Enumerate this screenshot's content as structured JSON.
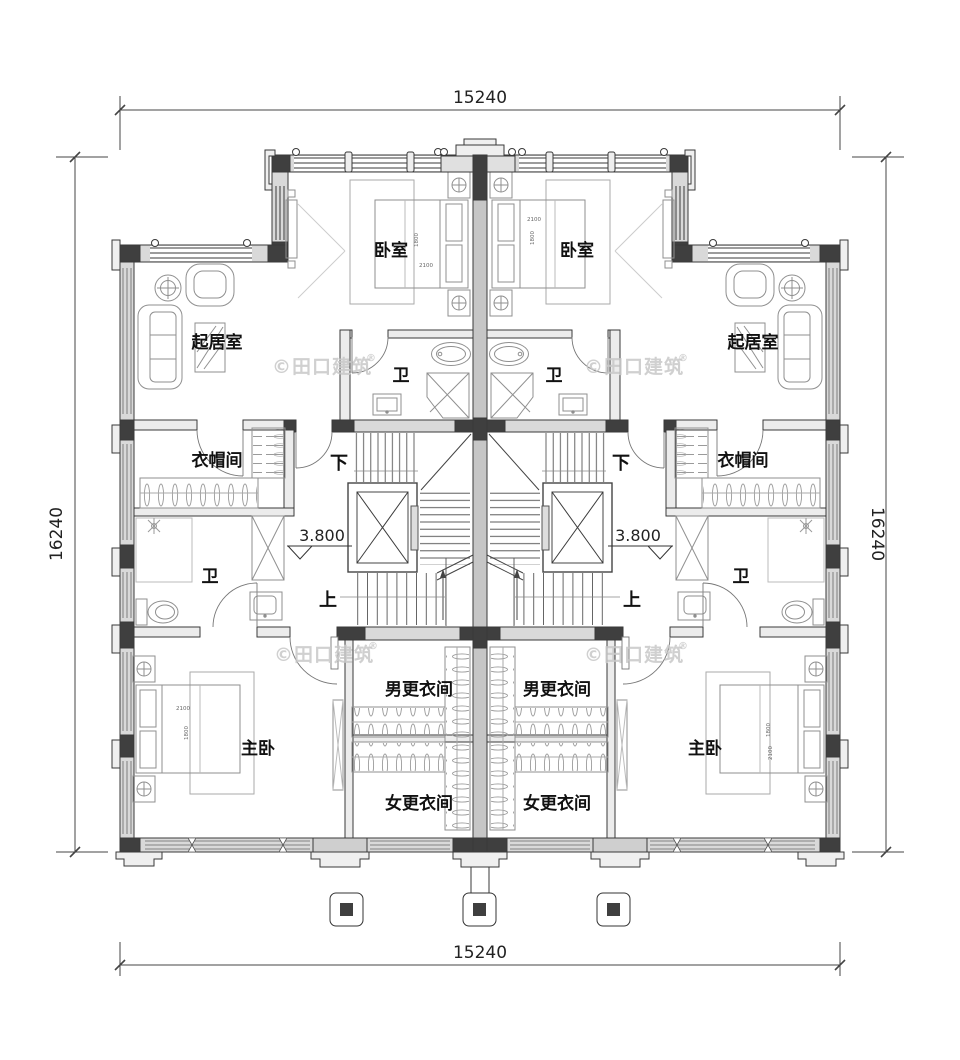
{
  "dimensions": {
    "top": "15240",
    "bottom": "15240",
    "left": "16240",
    "right": "16240"
  },
  "rooms": {
    "bedroom": "卧室",
    "living_room": "起居室",
    "bathroom": "卫",
    "cloakroom": "衣帽间",
    "master_bedroom": "主卧",
    "mens_dressing_room": "男更衣间",
    "womens_dressing_room": "女更衣间"
  },
  "stairs": {
    "down": "下",
    "up": "上"
  },
  "elevation_marker": {
    "value": "3.800"
  },
  "bed_dimensions": {
    "width": "2100",
    "depth": "1800"
  },
  "watermark": {
    "text": "©田口建筑",
    "registered": "®"
  },
  "colors": {
    "background": "#ffffff",
    "wall_fill": "#d9d9d9",
    "wall_dark": "#3f3f3f",
    "party_wall": "#c6c6c6",
    "line": "#3a3a3a",
    "furniture_line": "#8f8f8f",
    "label_text": "#111111",
    "dim_text": "#222222",
    "watermark": "#c8c8c8"
  }
}
